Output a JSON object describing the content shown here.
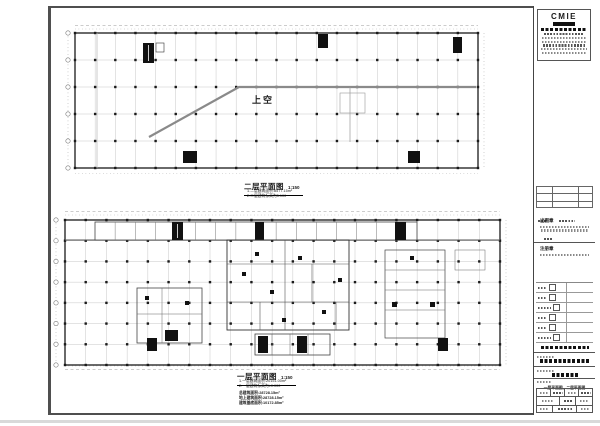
{
  "sheet": {
    "background": "#ffffff",
    "frame_color": "#4f4f4f"
  },
  "plans": {
    "second": {
      "title": "二层平面图",
      "scale": "1:150",
      "void_label": "上空",
      "notes": [
        "1.二层建筑面积:8577.15m²",
        "2.二层建筑标高为5.100"
      ]
    },
    "first": {
      "title": "一层平面图",
      "scale": "1:150",
      "notes": [
        "1.一层建筑面积:20151.00m²",
        "2.一层建筑标高为±0.000"
      ],
      "summary": [
        "总建筑面积:28728.15m²",
        "地上建筑面积:28728.15m²",
        "建筑基底面积:10172.85m²"
      ]
    }
  },
  "titleblock": {
    "logo_text": "CMIE",
    "stamp1_label": "出图章",
    "stamp2_label": "注册章",
    "drawing_name": "一层平面图、二层平面图"
  }
}
